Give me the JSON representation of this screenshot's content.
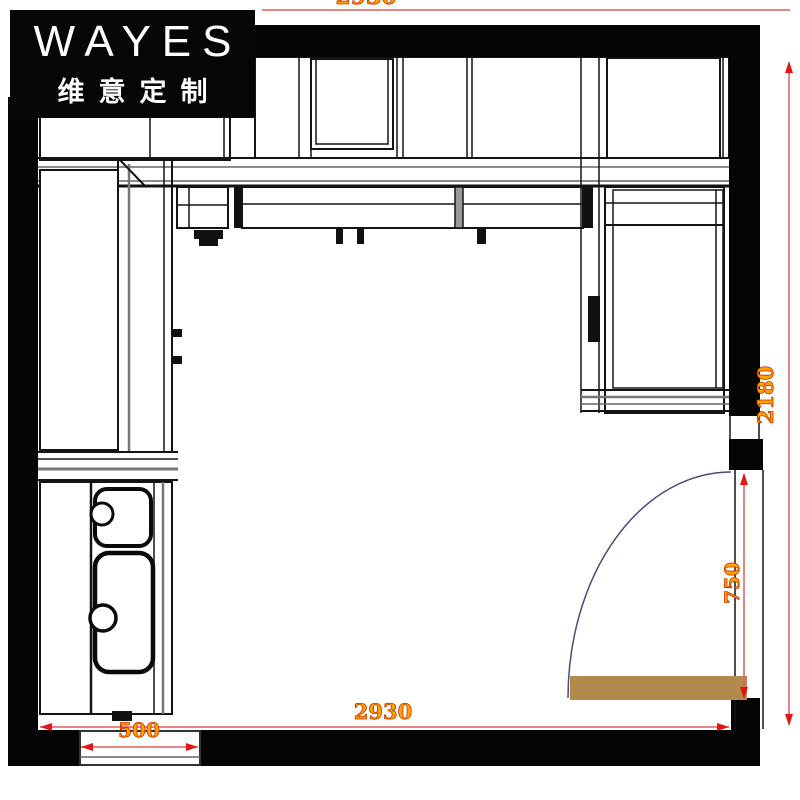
{
  "brand": {
    "name": "WAYES",
    "subtitle": "维意定制"
  },
  "dimensions": {
    "top_width": "2930",
    "right_height": "2180",
    "bottom_width": "2930",
    "door_opening_height": "750",
    "window_width": "500"
  },
  "colors": {
    "wall": "#050505",
    "cabinet_line": "#141414",
    "dimension_line": "#e05c5c",
    "dimension_arrow": "#e31515",
    "dimension_text": "#ffa200",
    "door_leaf": "#b48a4c",
    "door_swing_arc": "#4a4a7c",
    "logo_background": "#060606",
    "logo_text": "#ffffff"
  }
}
